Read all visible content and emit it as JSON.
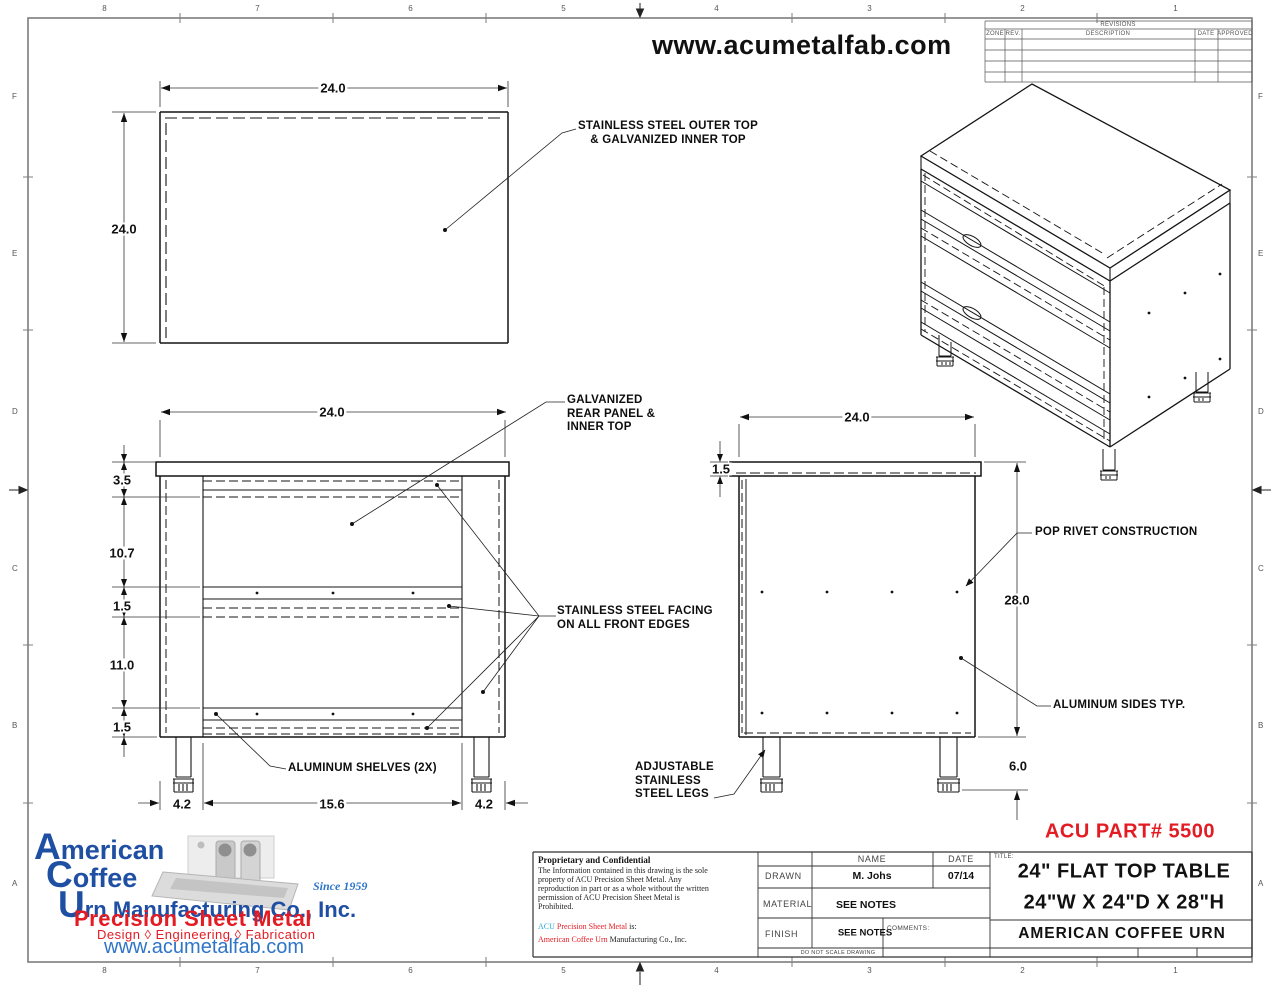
{
  "header": {
    "website": "www.acumetalfab.com"
  },
  "zones": {
    "top_numbers": [
      "8",
      "7",
      "6",
      "5",
      "4",
      "3",
      "2",
      "1"
    ],
    "bottom_numbers": [
      "8",
      "7",
      "6",
      "5",
      "4",
      "3",
      "2",
      "1"
    ],
    "left_letters": [
      "F",
      "E",
      "D",
      "C",
      "B",
      "A"
    ],
    "right_letters": [
      "F",
      "E",
      "D",
      "C",
      "B",
      "A"
    ]
  },
  "revisions": {
    "title": "REVISIONS",
    "columns": [
      "ZONE",
      "REV.",
      "DESCRIPTION",
      "DATE",
      "APPROVED"
    ]
  },
  "top_view": {
    "dim_width": "24.0",
    "dim_depth": "24.0",
    "callout_line1": "STAINLESS STEEL OUTER TOP",
    "callout_line2": "& GALVANIZED INNER TOP"
  },
  "front_view": {
    "dim_width": "24.0",
    "dim_top": "3.5",
    "dim_upper_opening": "10.7",
    "dim_shelf1": "1.5",
    "dim_lower_opening": "11.0",
    "dim_shelf2": "1.5",
    "dim_leg_left": "4.2",
    "dim_opening_width": "15.6",
    "dim_leg_right": "4.2",
    "callout_rear_line1": "GALVANIZED",
    "callout_rear_line2": "REAR PANEL &",
    "callout_rear_line3": "INNER TOP",
    "callout_facing_line1": "STAINLESS STEEL FACING",
    "callout_facing_line2": "ON ALL FRONT EDGES",
    "callout_shelves": "ALUMINUM SHELVES (2X)"
  },
  "side_view": {
    "dim_width": "24.0",
    "dim_top": "1.5",
    "dim_height": "28.0",
    "dim_leg_height": "6.0",
    "callout_rivet": "POP RIVET CONSTRUCTION",
    "callout_sides": "ALUMINUM SIDES TYP.",
    "callout_legs_line1": "ADJUSTABLE",
    "callout_legs_line2": "STAINLESS",
    "callout_legs_line3": "STEEL LEGS"
  },
  "logo": {
    "line1": "American",
    "line2": "Coffee",
    "line3": "Urn Manufacturing Co., Inc.",
    "since": "Since 1959",
    "tagline": "Precision Sheet Metal",
    "services": "Design  ◊  Engineering  ◊  Fabrication",
    "website": "www.acumetalfab.com"
  },
  "title_block": {
    "part_number": "ACU PART# 5500",
    "title_label": "TITLE:",
    "title_line1": "24\" FLAT TOP TABLE",
    "title_line2": "24\"W X 24\"D X 28\"H",
    "company": "AMERICAN COFFEE URN",
    "proprietary_title": "Proprietary and Confidential",
    "proprietary_lines": [
      "The Information contained in this drawing is the sole",
      "property of ACU Precision Sheet Metal. Any",
      "reproduction in part or as a whole without the written",
      "permission of ACU Precision Sheet Metal is",
      "Prohibited."
    ],
    "acu_cyan": "ACU",
    "acu_red": "Precision Sheet Metal",
    "acu_rest": "is:",
    "amer_red": "American Coffee Urn",
    "amer_rest": "Manufacturing Co., Inc.",
    "name_header": "NAME",
    "date_header": "DATE",
    "drawn_label": "DRAWN",
    "drawn_name": "M. Johs",
    "drawn_date": "07/14",
    "material_label": "MATERIAL",
    "material_value": "SEE NOTES",
    "finish_label": "FINISH",
    "finish_value": "SEE NOTES",
    "comments_label": "COMMENTS:",
    "do_not_scale": "DO NOT SCALE DRAWING"
  },
  "colors": {
    "red": "#e31b23",
    "blue_dark": "#1f4fa3",
    "blue_light": "#2e75c7",
    "cyan": "#29abe2"
  }
}
